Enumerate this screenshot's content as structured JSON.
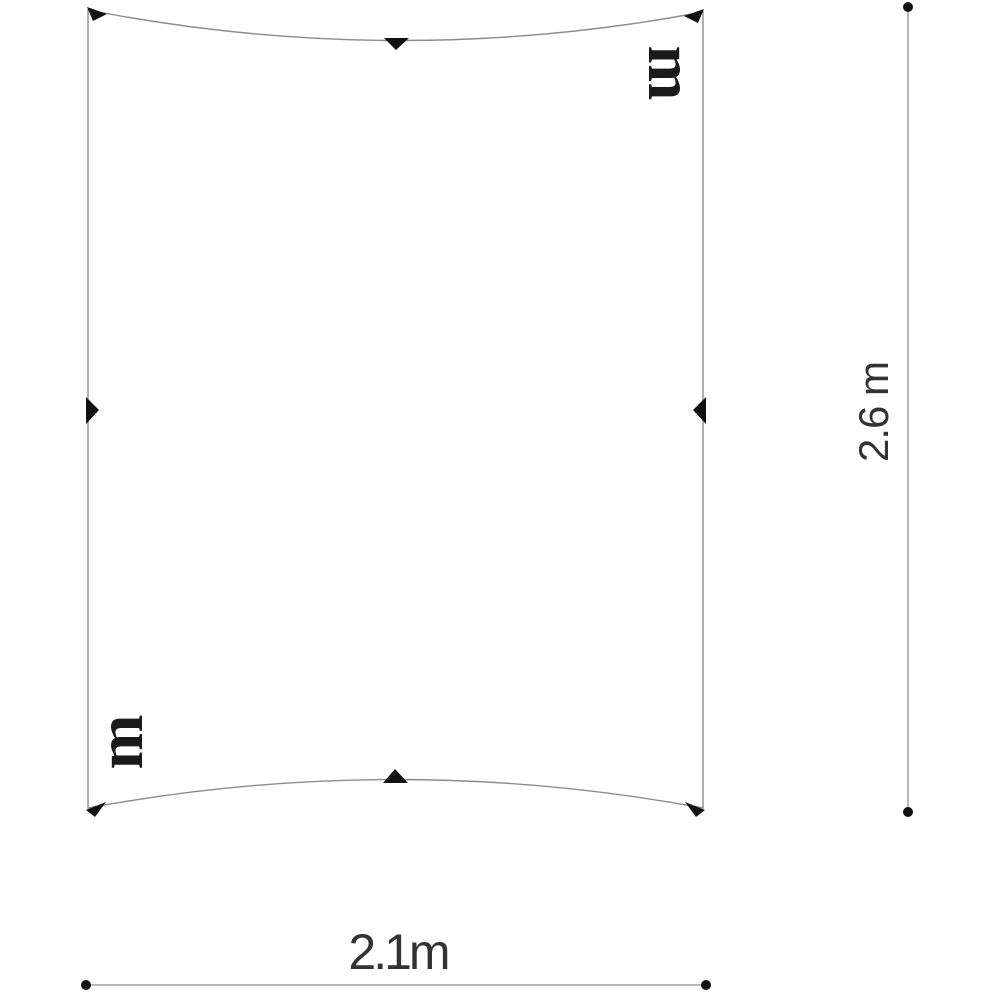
{
  "diagram": {
    "kind": "tarp-dimension-diagram",
    "width_label": "2.1m",
    "height_label": "2.6 m",
    "fabric_mark_top_right": "m",
    "fabric_mark_bottom_left": "m",
    "dimensions": {
      "width_m": 2.1,
      "height_m": 2.6
    },
    "colors": {
      "background": "#ffffff",
      "outline": "#8c8c8c",
      "dimension_line": "#b8b8b8",
      "marker": "#111111",
      "text": "#333333"
    }
  }
}
